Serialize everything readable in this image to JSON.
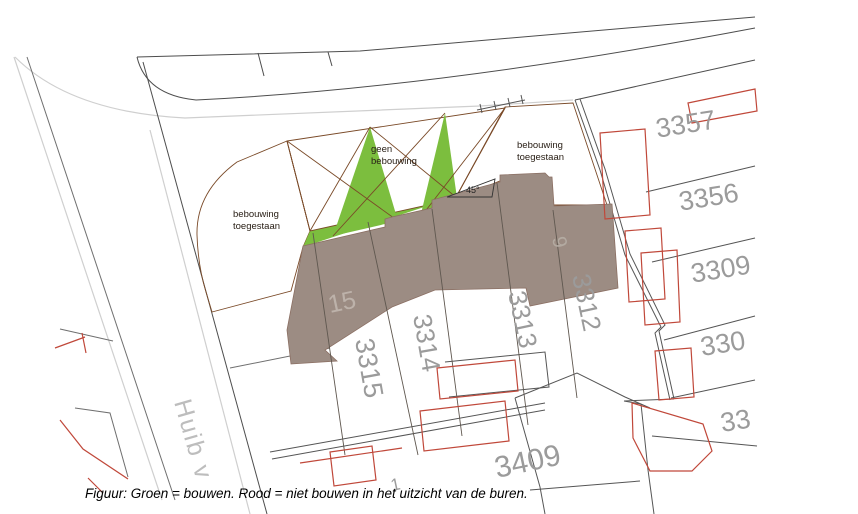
{
  "map": {
    "street_name": "Huib v",
    "zones": {
      "left_allowed": {
        "line1": "bebouwing",
        "line2": "toegestaan"
      },
      "no_building": {
        "line1": "geen",
        "line2": "bebouwing"
      },
      "right_allowed": {
        "line1": "bebouwing",
        "line2": "toegestaan"
      },
      "angle_label": "45°"
    },
    "parcel_numbers": {
      "right_column": [
        "3357",
        "3356",
        "3309",
        "330",
        "33"
      ],
      "rotated": [
        "3315",
        "3314",
        "3313",
        "3312"
      ],
      "bottom": "3409",
      "house_left": "15",
      "house_right": "9",
      "small": "1"
    },
    "colors": {
      "allowed": "#7cbe3e",
      "forbidden": "#ef8950",
      "building": "#9c8c83",
      "neighbor_outline": "#c0483a"
    }
  },
  "caption": "Figuur: Groen = bouwen. Rood = niet bouwen in het uitzicht van de buren."
}
